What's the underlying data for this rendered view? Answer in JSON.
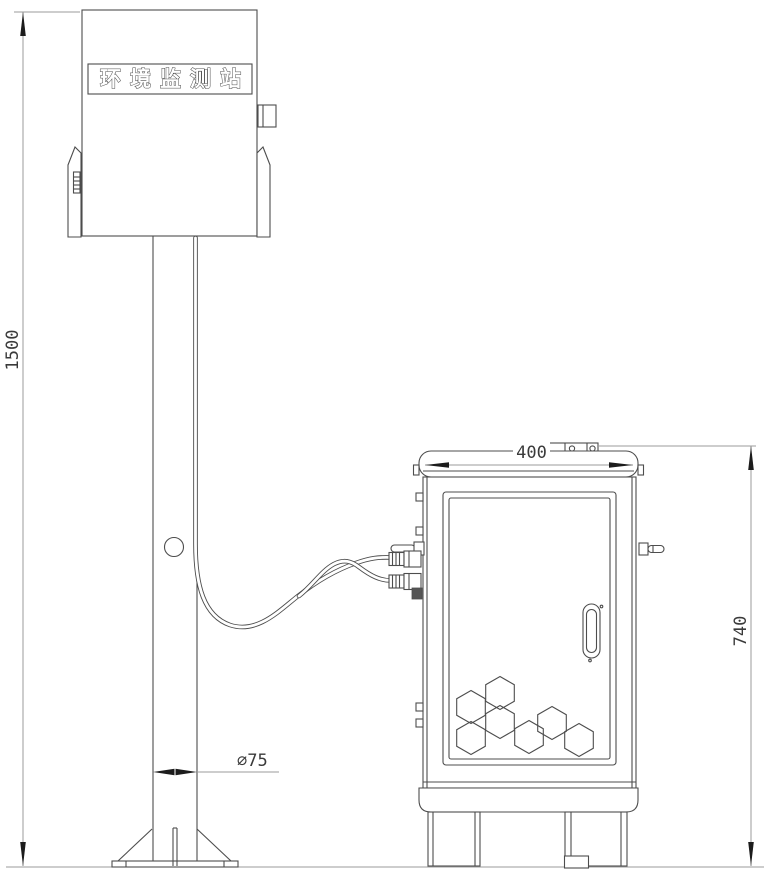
{
  "diagram": {
    "station_label": "环境监测站",
    "dimensions": {
      "pole_height": "1500",
      "cabinet_width": "400",
      "cabinet_height": "740",
      "pole_diameter": "∅75"
    },
    "colors": {
      "outline": "#4d4d4d",
      "dimension": "#9b9b9b",
      "arrow": "#1c1c1c",
      "background": "#ffffff"
    }
  }
}
